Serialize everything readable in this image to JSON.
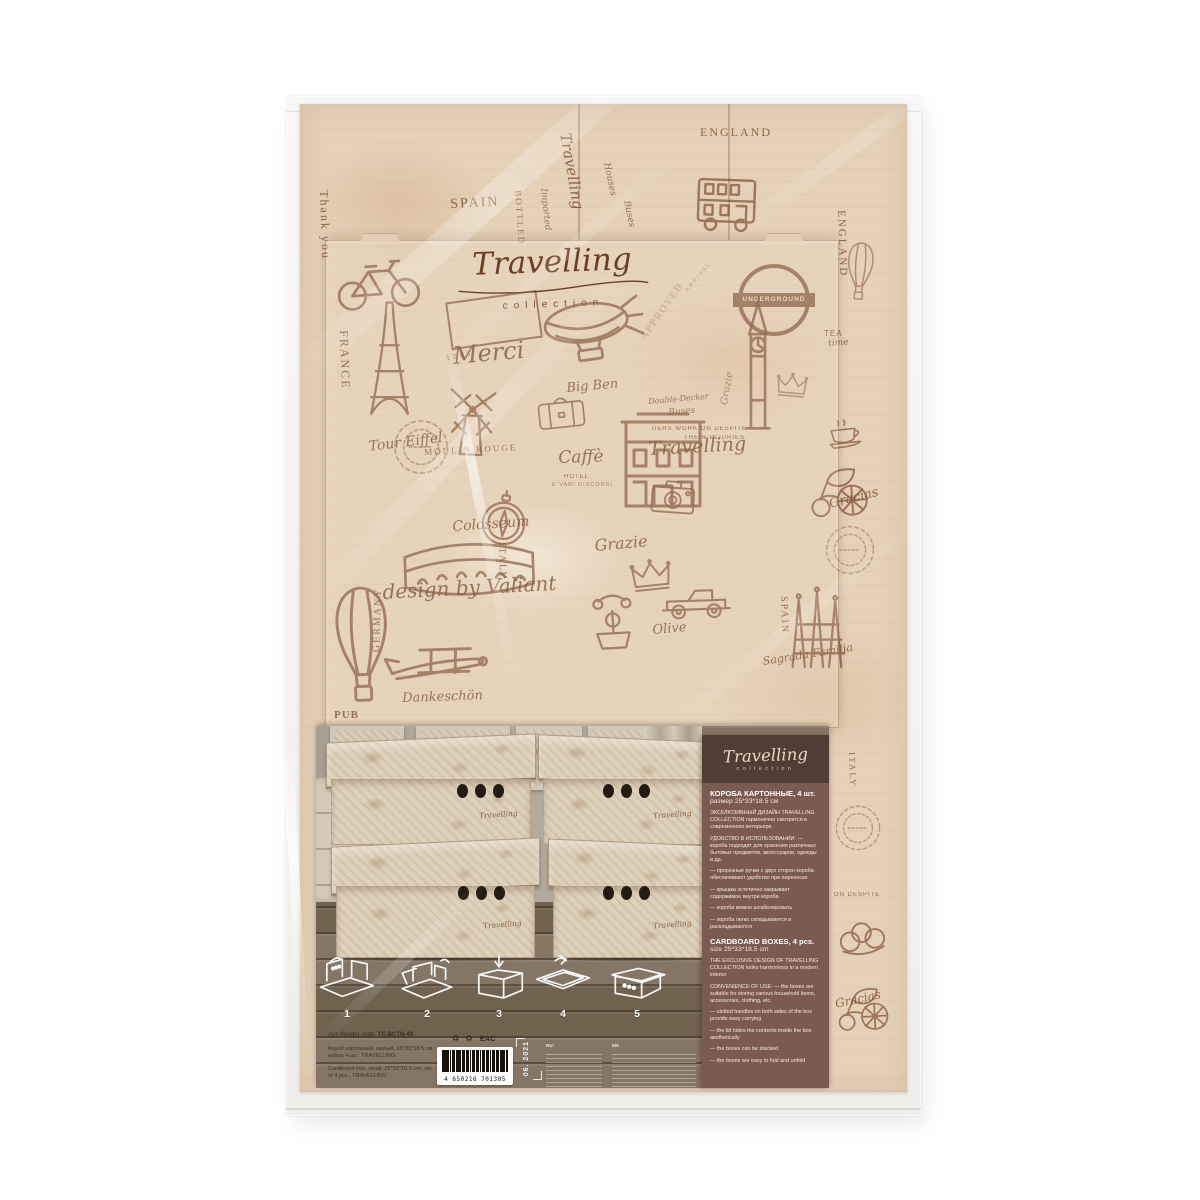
{
  "brand": {
    "script": "Travelling",
    "sub": "collection"
  },
  "pattern": {
    "underground": "UNDERGROUND",
    "stamp": {
      "top": "ARRIVAL",
      "mid": "APPROVED",
      "num": "1245"
    },
    "words": [
      {
        "t": "Thank you",
        "x": 30,
        "y": 86,
        "s": 12,
        "r": 88,
        "c": "caps"
      },
      {
        "t": "SPAIN",
        "x": 150,
        "y": 94,
        "s": 14,
        "r": -3,
        "c": "caps"
      },
      {
        "t": "Travelling",
        "x": 272,
        "y": 28,
        "s": 15,
        "r": 80,
        "c": "script"
      },
      {
        "t": "BOTTLED",
        "x": 222,
        "y": 86,
        "s": 9,
        "r": 86,
        "c": "caps",
        "o": 0.7
      },
      {
        "t": "Imported",
        "x": 247,
        "y": 84,
        "s": 9,
        "r": 84,
        "c": "script",
        "o": 0.7
      },
      {
        "t": "Houses",
        "x": 310,
        "y": 58,
        "s": 9,
        "r": 78,
        "c": "script",
        "o": 0.75
      },
      {
        "t": "Buses",
        "x": 330,
        "y": 96,
        "s": 9,
        "r": 78,
        "c": "script",
        "o": 0.75
      },
      {
        "t": "ENGLAND",
        "x": 400,
        "y": 22,
        "s": 12,
        "r": 0,
        "c": "caps"
      },
      {
        "t": "ENGLAND",
        "x": 546,
        "y": 106,
        "s": 11,
        "r": 88,
        "c": "caps"
      },
      {
        "t": "TEA",
        "x": 524,
        "y": 226,
        "s": 8,
        "r": 0,
        "c": "sans"
      },
      {
        "t": "time",
        "x": 528,
        "y": 236,
        "s": 9,
        "r": -4,
        "c": "script"
      },
      {
        "t": "UERS WORK ON DESPITE",
        "x": 352,
        "y": 322,
        "s": 6,
        "r": 0,
        "c": "sans",
        "o": 0.85
      },
      {
        "t": "THEIR INJURIES.",
        "x": 384,
        "y": 331,
        "s": 6,
        "r": 0,
        "c": "sans",
        "o": 0.85
      },
      {
        "t": "Double-Decker",
        "x": 348,
        "y": 294,
        "s": 8,
        "r": -5,
        "c": "script",
        "o": 0.8
      },
      {
        "t": "Buses",
        "x": 368,
        "y": 305,
        "s": 9,
        "r": -5,
        "c": "script",
        "o": 0.8
      },
      {
        "t": "FRANCE",
        "x": 50,
        "y": 226,
        "s": 12,
        "r": 88,
        "c": "caps"
      },
      {
        "t": "Tour Eiffel",
        "x": 68,
        "y": 336,
        "s": 14,
        "r": -7,
        "c": "script"
      },
      {
        "t": "Merci",
        "x": 152,
        "y": 240,
        "s": 24,
        "r": -5,
        "c": "script"
      },
      {
        "t": "Big Ben",
        "x": 266,
        "y": 278,
        "s": 13,
        "r": -5,
        "c": "script"
      },
      {
        "t": "Travelling",
        "x": 348,
        "y": 336,
        "s": 19,
        "r": -3,
        "c": "script"
      },
      {
        "t": "Caffè",
        "x": 258,
        "y": 346,
        "s": 17,
        "r": -2,
        "c": "script"
      },
      {
        "t": "HOTEL",
        "x": 264,
        "y": 370,
        "s": 6,
        "r": 0,
        "c": "sans"
      },
      {
        "t": "E VARI DISCORSI",
        "x": 252,
        "y": 379,
        "s": 5.5,
        "r": 0,
        "c": "sans",
        "o": 0.75
      },
      {
        "t": "MOULIN ROUGE",
        "x": 124,
        "y": 344,
        "s": 9,
        "r": -3,
        "c": "caps"
      },
      {
        "t": "Colosseum",
        "x": 152,
        "y": 416,
        "s": 14,
        "r": -4,
        "c": "script"
      },
      {
        "t": "ITALY",
        "x": 206,
        "y": 438,
        "s": 10,
        "r": 88,
        "c": "caps"
      },
      {
        "t": "Grazie",
        "x": 294,
        "y": 434,
        "s": 16,
        "r": -5,
        "c": "script"
      },
      {
        "t": "Gracias",
        "x": 528,
        "y": 394,
        "s": 13,
        "r": -14,
        "c": "script"
      },
      {
        "t": "design by Valiant",
        "x": 82,
        "y": 478,
        "s": 20,
        "r": -3,
        "c": "script"
      },
      {
        "t": "Dankeschön",
        "x": 102,
        "y": 588,
        "s": 13,
        "r": -2,
        "c": "script"
      },
      {
        "t": "GERMANY",
        "x": 72,
        "y": 548,
        "s": 10,
        "r": -88,
        "c": "caps"
      },
      {
        "t": "PUB",
        "x": 34,
        "y": 606,
        "s": 11,
        "r": 0,
        "c": "caps-bold"
      },
      {
        "t": "Olive",
        "x": 352,
        "y": 520,
        "s": 13,
        "r": -5,
        "c": "script"
      },
      {
        "t": "SPAIN",
        "x": 488,
        "y": 492,
        "s": 10,
        "r": 88,
        "c": "caps"
      },
      {
        "t": "Sagrada Familia",
        "x": 462,
        "y": 552,
        "s": 11,
        "r": -9,
        "c": "script"
      },
      {
        "t": "Grazie",
        "x": 420,
        "y": 300,
        "s": 10,
        "r": -80,
        "c": "script",
        "o": 0.6
      },
      {
        "t": "ITALY",
        "x": 556,
        "y": 648,
        "s": 9,
        "r": 88,
        "c": "caps",
        "o": 0.8
      },
      {
        "t": "ON  DESPITE",
        "x": 534,
        "y": 788,
        "s": 6,
        "r": 0,
        "c": "sans",
        "o": 0.8
      },
      {
        "t": "Gracias",
        "x": 534,
        "y": 894,
        "s": 12,
        "r": -12,
        "c": "script"
      }
    ],
    "motifs": [
      {
        "n": "m-bicycle",
        "x": 28,
        "y": 146,
        "w": 100,
        "h": 62,
        "r": -4
      },
      {
        "n": "m-eiffel",
        "x": 64,
        "y": 194,
        "w": 48,
        "h": 122
      },
      {
        "n": "m-windmill",
        "x": 136,
        "y": 282,
        "w": 72,
        "h": 74,
        "r": 3
      },
      {
        "n": "m-suitcase",
        "x": 236,
        "y": 286,
        "w": 50,
        "h": 40,
        "r": -6
      },
      {
        "n": "m-airship",
        "x": 238,
        "y": 182,
        "w": 108,
        "h": 92,
        "r": -8
      },
      {
        "n": "m-bigben",
        "x": 436,
        "y": 190,
        "w": 44,
        "h": 142
      },
      {
        "n": "m-bus",
        "x": 392,
        "y": 70,
        "w": 72,
        "h": 60,
        "r": 2
      },
      {
        "n": "m-colosseum",
        "x": 88,
        "y": 428,
        "w": 162,
        "h": 64,
        "r": -2
      },
      {
        "n": "m-compass",
        "x": 176,
        "y": 384,
        "w": 56,
        "h": 62,
        "r": 6
      },
      {
        "n": "m-facade",
        "x": 318,
        "y": 308,
        "w": 90,
        "h": 100
      },
      {
        "n": "m-crown",
        "x": 328,
        "y": 454,
        "w": 46,
        "h": 34,
        "r": -6
      },
      {
        "n": "m-car",
        "x": 352,
        "y": 474,
        "w": 88,
        "h": 44,
        "r": -2
      },
      {
        "n": "m-phone",
        "x": 286,
        "y": 482,
        "w": 52,
        "h": 68,
        "r": -3
      },
      {
        "n": "m-carriage",
        "x": 508,
        "y": 358,
        "w": 66,
        "h": 58,
        "r": -4
      },
      {
        "n": "m-teacup",
        "x": 524,
        "y": 314,
        "w": 44,
        "h": 32,
        "r": -6
      },
      {
        "n": "m-sagrada",
        "x": 482,
        "y": 476,
        "w": 76,
        "h": 98
      },
      {
        "n": "m-camera",
        "x": 348,
        "y": 374,
        "w": 50,
        "h": 38,
        "r": 4
      },
      {
        "n": "m-balloon",
        "x": 22,
        "y": 478,
        "w": 80,
        "h": 128,
        "r": -2
      },
      {
        "n": "m-plane",
        "x": 84,
        "y": 530,
        "w": 112,
        "h": 58,
        "r": -6
      },
      {
        "n": "m-stampcircle",
        "x": 92,
        "y": 314,
        "w": 58,
        "h": 58,
        "o": 0.5
      },
      {
        "n": "m-stampcircle",
        "x": 524,
        "y": 420,
        "w": 52,
        "h": 52,
        "o": 0.45
      },
      {
        "n": "m-stampcircle",
        "x": 534,
        "y": 700,
        "w": 48,
        "h": 48,
        "o": 0.5
      },
      {
        "n": "m-pretzel",
        "x": 534,
        "y": 812,
        "w": 56,
        "h": 42,
        "r": -8
      },
      {
        "n": "m-carriage",
        "x": 536,
        "y": 878,
        "w": 58,
        "h": 52,
        "r": -3
      },
      {
        "n": "m-balloon",
        "x": 540,
        "y": 136,
        "w": 40,
        "h": 64,
        "r": 4,
        "o": 0.6
      },
      {
        "n": "m-crown",
        "x": 474,
        "y": 268,
        "w": 36,
        "h": 26,
        "r": 5,
        "o": 0.6
      }
    ]
  },
  "panel": {
    "ru": {
      "title": "КОРОБА КАРТОННЫЕ, 4 шт.",
      "size": "размер 25*33*18.5 см",
      "paras": [
        "ЭКСКЛЮЗИВНЫЙ ДИЗАЙН TRAVELLING COLLECTION гармонично смотрится в современном интерьере",
        "УДОБСТВО В ИСПОЛЬЗОВАНИИ: — короба подходят для хранения различных бытовых предметов, аксессуаров, одежды и др.",
        "— прорезные ручки с двух сторон короба обеспечивают удобство при переноске",
        "— крышка эстетично закрывает содержимое внутри короба",
        "— короба можно штабелировать",
        "— короба легко складываются и раскладываются"
      ]
    },
    "en": {
      "title": "CARDBOARD BOXES, 4 pcs.",
      "size": "size 25*33*18.5 cm",
      "paras": [
        "THE EXCLUSIVE DESIGN OF TRAVELLING COLLECTION looks harmonious in a modern interior",
        "CONVENIENCE OF USE: — the boxes are suitable for storing various household items, accessories, clothing, etc.",
        "— slotted handles on both sides of the box  provide easy carrying",
        "— the lid hides  the contents inside the box aesthetically",
        "— the boxes can be stacked",
        "— the boxes are easy to fold and unfold"
      ]
    }
  },
  "photo": {
    "boxes": [
      {
        "x": 15,
        "y": 12,
        "w": 200,
        "h": 107,
        "hx": 126,
        "hy": 46,
        "side": "l",
        "label": "Travelling"
      },
      {
        "x": 227,
        "y": 12,
        "w": 162,
        "h": 107,
        "hx": 60,
        "hy": 46,
        "side": "r",
        "label": "Travelling"
      },
      {
        "x": 20,
        "y": 116,
        "w": 199,
        "h": 116,
        "hx": 122,
        "hy": 44,
        "side": "l",
        "label": "Travelling"
      },
      {
        "x": 237,
        "y": 116,
        "w": 152,
        "h": 116,
        "hx": 50,
        "hy": 44,
        "side": "r",
        "label": "Travelling"
      }
    ]
  },
  "footer": {
    "steps": [
      "1",
      "2",
      "3",
      "4",
      "5"
    ],
    "vendor_label": "Арт./Vendor code:",
    "vendor_code": "TC-BCTN-4S",
    "desc_ru": "Короб картонный, малый, 25*33*18.5 см, набор 4 шт., TRAVELLING",
    "desc_en": "Cardboard box, small, 25*33*18.5 cm, set of 4 pcs., TRAVELLING",
    "recycle": "♻ ♻",
    "eac": "EAC",
    "barcode_number": "4 650216 701305",
    "date_stamp": "06. 2021",
    "fineprint_ru_label": "RU:",
    "fineprint_en_label": "EN:"
  },
  "colors": {
    "cardboard": "#e5d1b8",
    "ink": "#8a5f45",
    "panel": "#7b5b51",
    "panel_dark": "#523d35",
    "wood": "#7d6e5f",
    "cream": "#ead9c4"
  }
}
